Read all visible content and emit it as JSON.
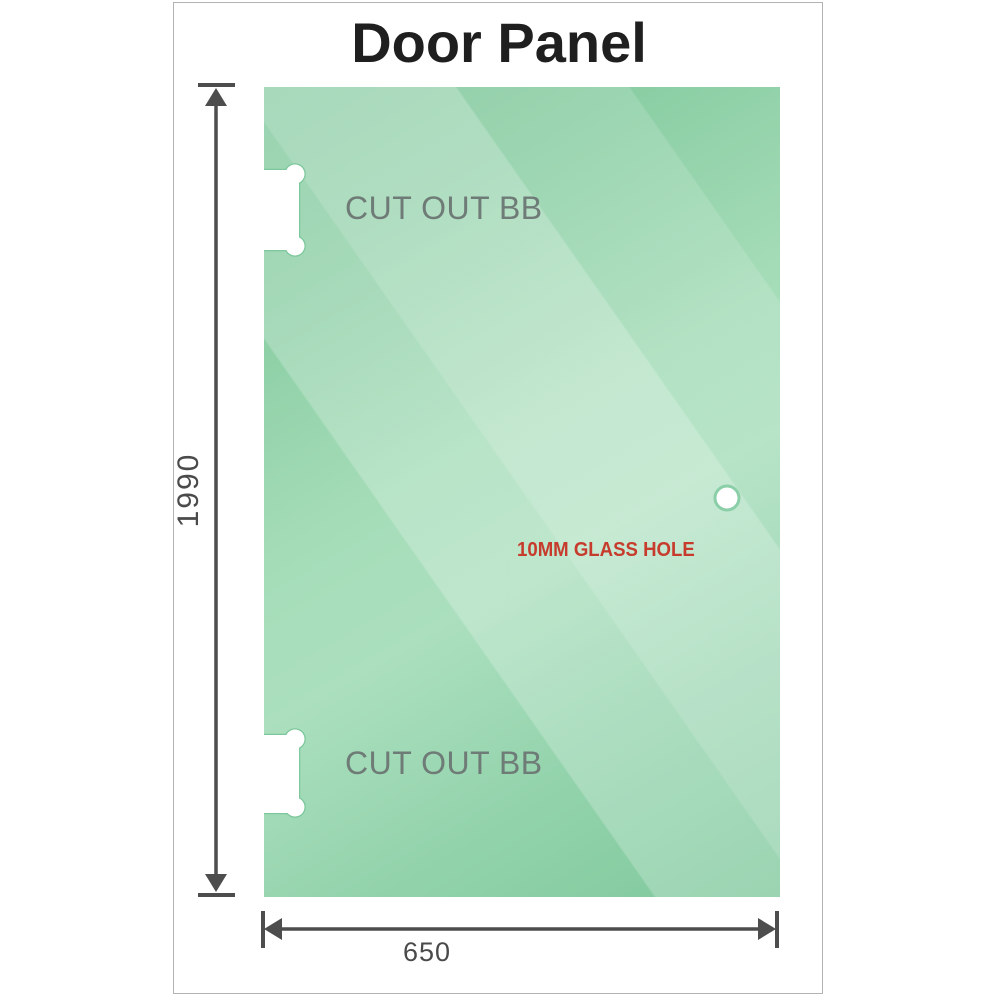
{
  "title": "Door Panel",
  "panel": {
    "cutouts": [
      {
        "label": "CUT OUT BB"
      },
      {
        "label": "CUT OUT BB"
      }
    ],
    "hole": {
      "label": "10MM GLASS HOLE"
    }
  },
  "dimensions": {
    "height": "1990",
    "width": "650"
  },
  "colors": {
    "glass_base": "#84cba0",
    "glass_light": "#bce6cb",
    "cutout_outline": "#7cc79b",
    "cutout_label_gray": "#6f7b77",
    "hole_label_red": "#c73b2d",
    "dimension_gray": "#4d4d4d",
    "title_color": "#1f1f1f",
    "frame_border": "#b3b3b3"
  }
}
